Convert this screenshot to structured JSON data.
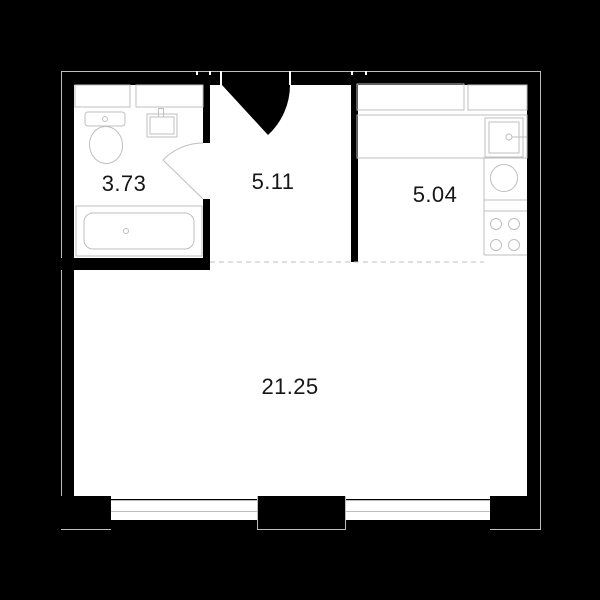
{
  "plan": {
    "type": "apartment-floor-plan",
    "rooms": {
      "bathroom": {
        "label": "3.73"
      },
      "hallway": {
        "label": "5.11"
      },
      "kitchen": {
        "label": "5.04"
      },
      "living_room": {
        "label": "21.25"
      }
    },
    "fixtures": [
      "toilet",
      "bathroom-sink",
      "bathtub",
      "bathroom-door-swing",
      "entry-door-swing",
      "kitchen-upper-cabinets",
      "kitchen-counter",
      "kitchen-sink",
      "refrigerator",
      "stove-4-burner",
      "window-left",
      "window-right"
    ],
    "colors": {
      "background": "#000000",
      "floor": "#ffffff",
      "walls": "#000000",
      "outline": "#bdbdbd",
      "label_text": "#161616"
    }
  }
}
